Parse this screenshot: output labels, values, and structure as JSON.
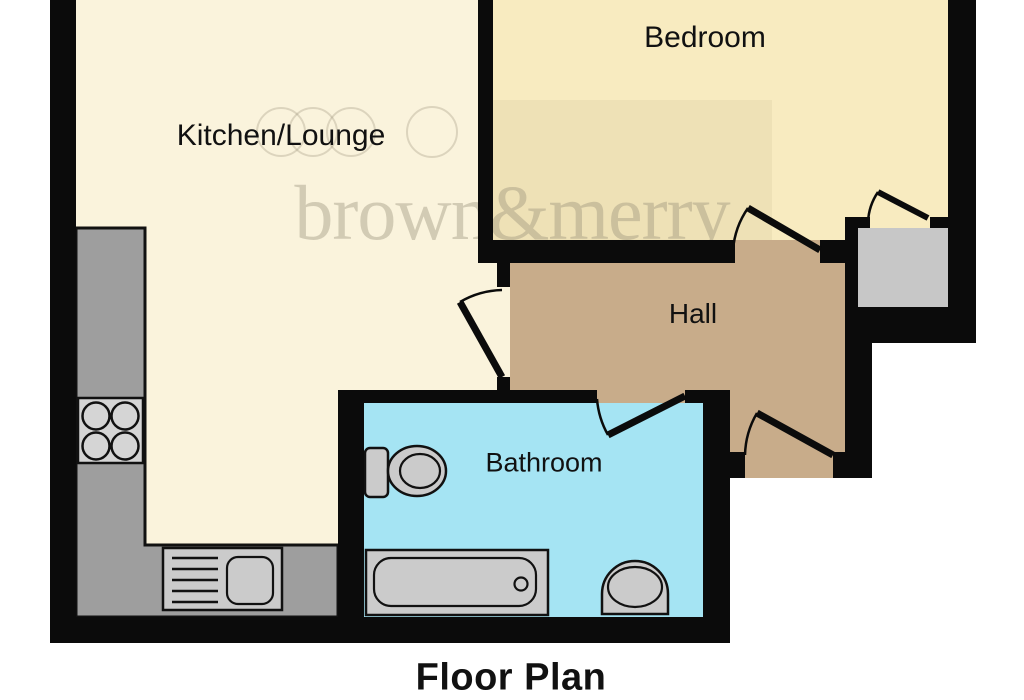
{
  "title": {
    "text": "Floor Plan"
  },
  "watermark": {
    "text": "brown&merry",
    "logo": "overlapping-rings-logo"
  },
  "rooms": {
    "kitchen": {
      "label": "Kitchen/Lounge",
      "color": "#FAF3DC"
    },
    "bedroom": {
      "label": "Bedroom",
      "color": "#F8EBC0"
    },
    "hall": {
      "label": "Hall",
      "color": "#C8AC8A"
    },
    "bathroom": {
      "label": "Bathroom",
      "color": "#A5E4F3"
    },
    "cupboard": {
      "label": "",
      "color": "#C7C7C7"
    }
  },
  "fixtures": {
    "hob": "four-ring-hob-icon",
    "sink": "sink-with-drainer-icon",
    "toilet": "toilet-icon",
    "bath": "bathtub-icon",
    "basin": "wash-basin-icon"
  },
  "doors": [
    "kitchen-door",
    "bedroom-door",
    "cupboard-door",
    "bathroom-door",
    "front-door"
  ],
  "colors": {
    "wall": "#0B0B0B",
    "outline": "#111111",
    "counter": "#9E9E9E",
    "fixture": "#CBCBCB",
    "hob-plate": "#D5D5D5",
    "watermark": "rgba(151,142,120,0.40)",
    "watermark-rings": "rgba(151,142,120,0.30)",
    "title": "#111111",
    "label": "#111111"
  }
}
